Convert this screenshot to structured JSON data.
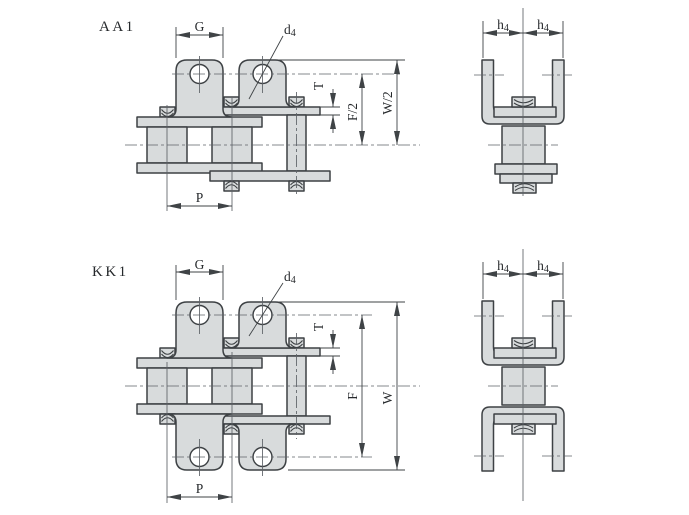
{
  "drawing": {
    "description": "Roller chain attachment engineering drawing",
    "background_color": "#ffffff",
    "colors": {
      "outline": "#3d4144",
      "fill": "#d8dbdc",
      "dimension": "#3f4346",
      "centerline": "#5d6267",
      "text": "#26292c"
    },
    "views": {
      "aa1_side": {
        "title": "AA1",
        "dim_g": "G",
        "dim_d_main": "d",
        "dim_d_sub": "4",
        "dim_p": "P",
        "dim_t": "T",
        "dim_f_half": "F/2",
        "dim_w_half": "W/2"
      },
      "aa1_end": {
        "dim_h_left": "h",
        "dim_h_left_sub": "4",
        "dim_h_right": "h",
        "dim_h_right_sub": "4"
      },
      "kk1_side": {
        "title": "KK1",
        "dim_g": "G",
        "dim_d_main": "d",
        "dim_d_sub": "4",
        "dim_p": "P",
        "dim_t": "T",
        "dim_f": "F",
        "dim_w": "W"
      },
      "kk1_end": {
        "dim_h_left": "h",
        "dim_h_left_sub": "4",
        "dim_h_right": "h",
        "dim_h_right_sub": "4"
      }
    }
  }
}
